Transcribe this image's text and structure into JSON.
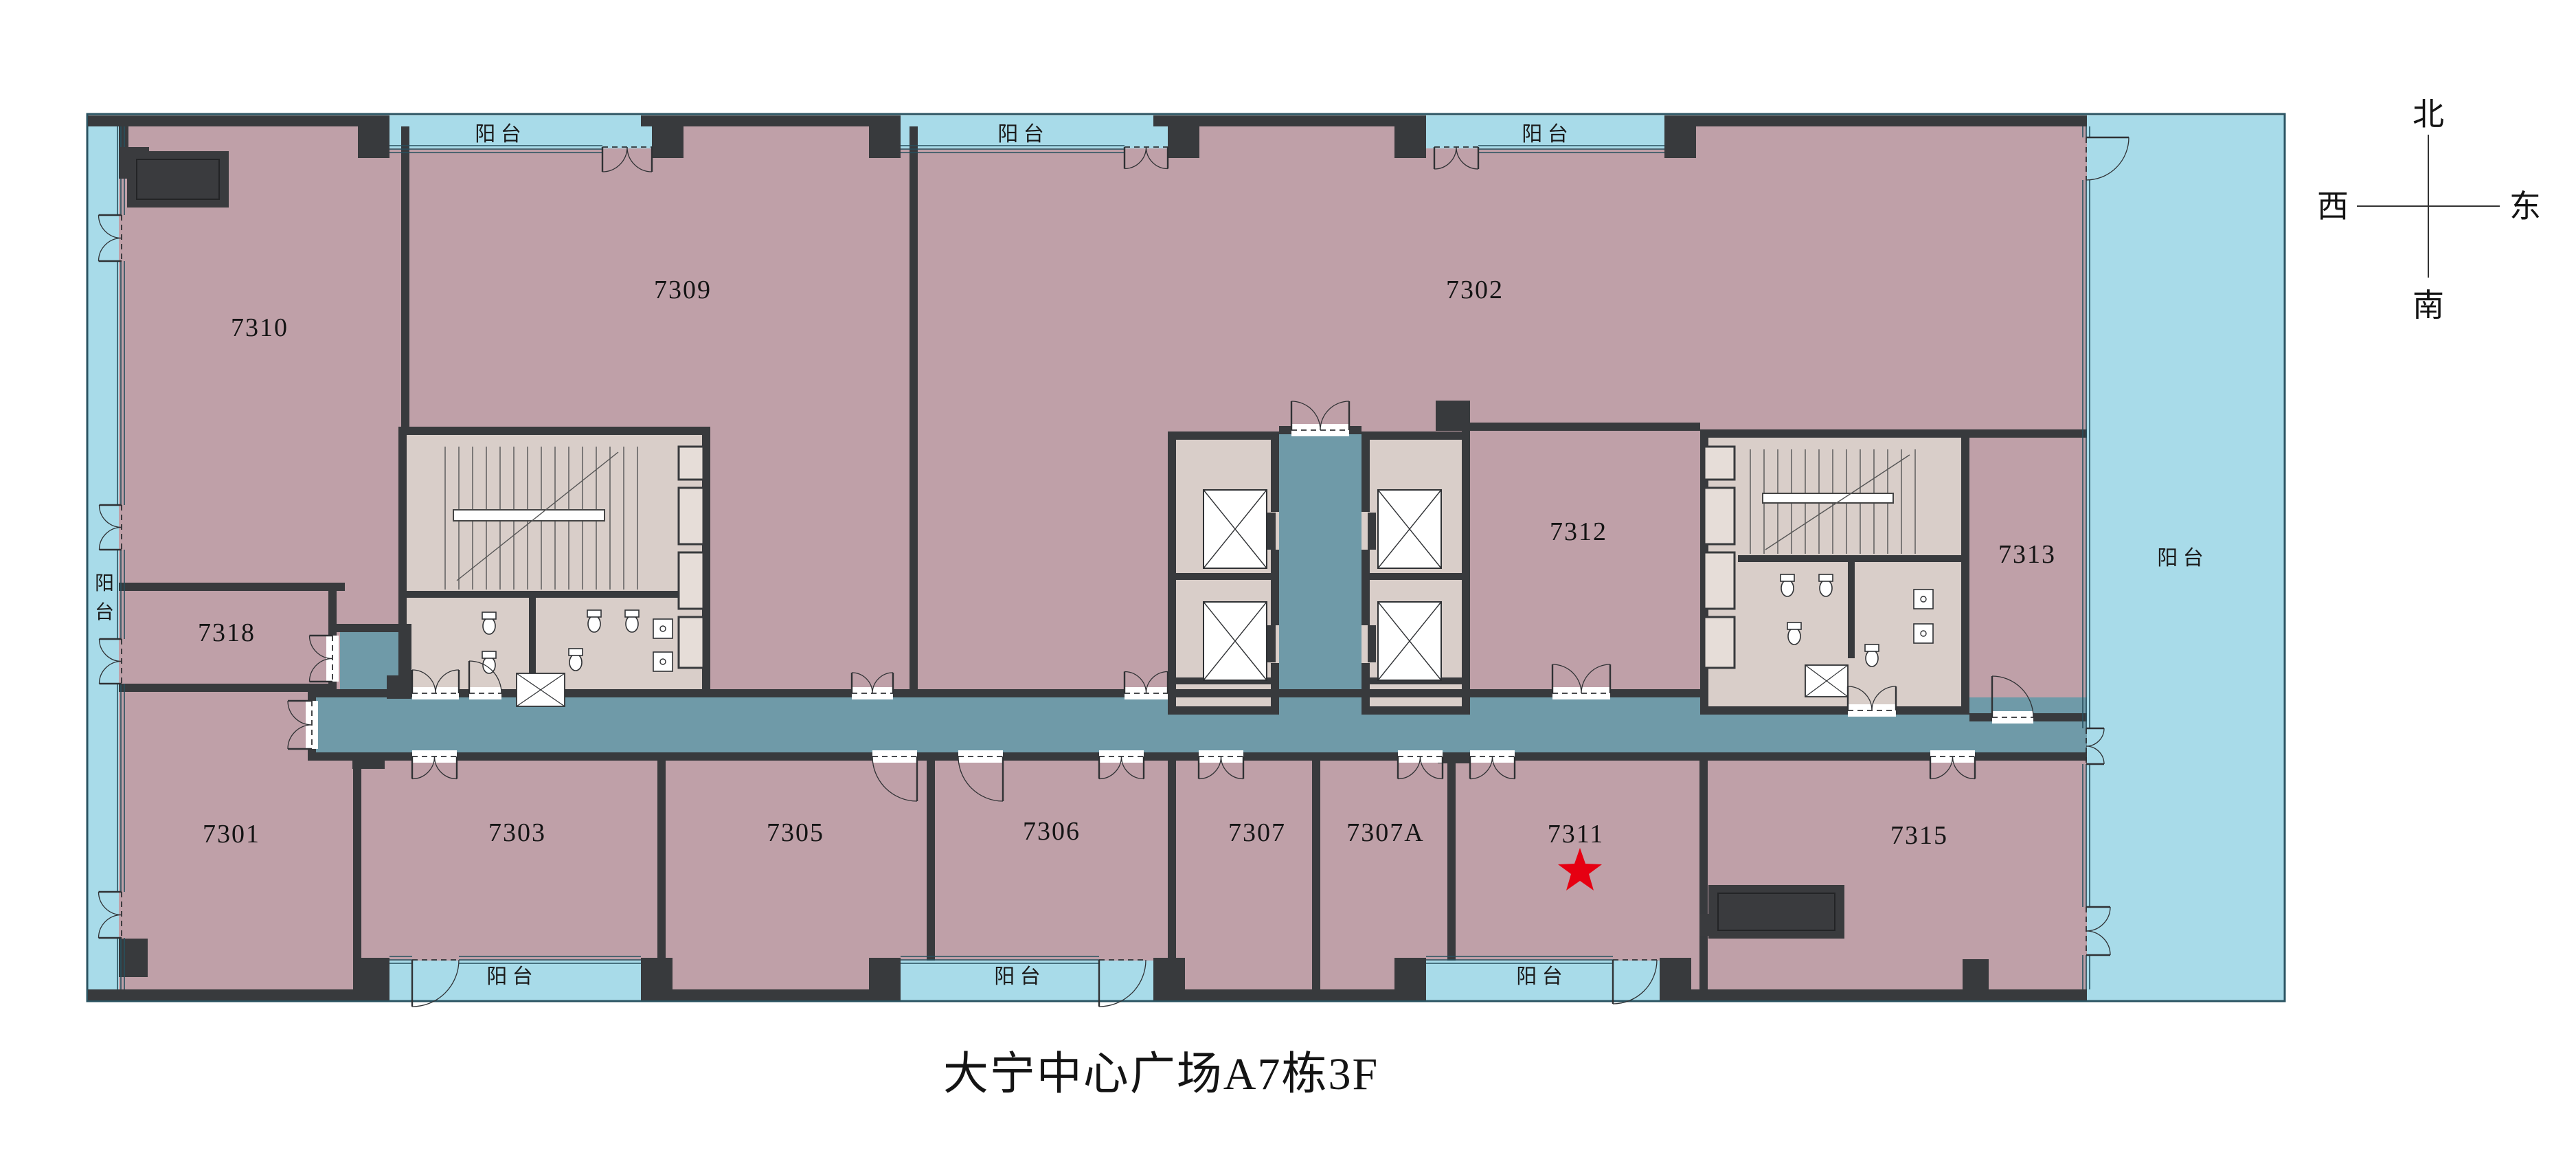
{
  "title": "大宁中心广场A7栋3F",
  "compass": {
    "north": "北",
    "east": "东",
    "south": "南",
    "west": "西"
  },
  "balcony_label": "阳 台",
  "balcony_vertical": {
    "top_char": "阳",
    "bottom_char": "台"
  },
  "rooms": {
    "r7310": "7310",
    "r7309": "7309",
    "r7302": "7302",
    "r7318": "7318",
    "r7312": "7312",
    "r7313": "7313",
    "r7301": "7301",
    "r7303": "7303",
    "r7305": "7305",
    "r7306": "7306",
    "r7307": "7307",
    "r7307A": "7307A",
    "r7311": "7311",
    "r7315": "7315"
  },
  "marker": {
    "type": "red-star",
    "room": "7311"
  },
  "palette": {
    "room_fill": "#bfa0a8",
    "balcony_fill": "#a8dbe9",
    "corridor_fill": "#6f9aa8",
    "core_fill": "#d9cec9",
    "wall": "#383a3d",
    "boundary_line": "#2b5462",
    "window_line": "#27505e",
    "star": "#e60012",
    "label": "#141414"
  }
}
